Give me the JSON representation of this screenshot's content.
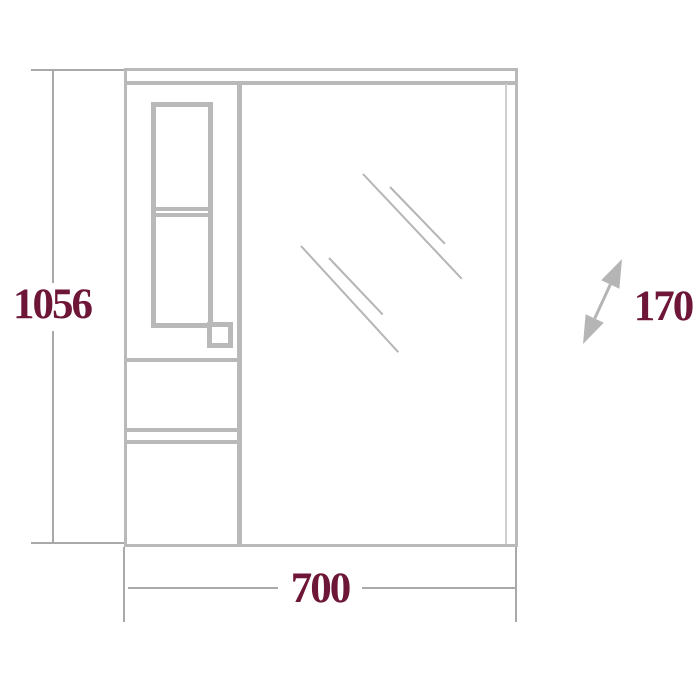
{
  "drawing": {
    "labels": {
      "height": "1056",
      "width": "700",
      "depth": "170"
    },
    "colors": {
      "structure_gray": "#b9b9b9",
      "faint_gray": "#cfcfcf",
      "dimension_gray": "#a9a9a9",
      "mirror_gray": "#b5b5b5",
      "label_maroon": "#6d1637",
      "background": "#ffffff"
    },
    "icons": {
      "depth_arrow": "diagonal-double-arrow"
    }
  }
}
